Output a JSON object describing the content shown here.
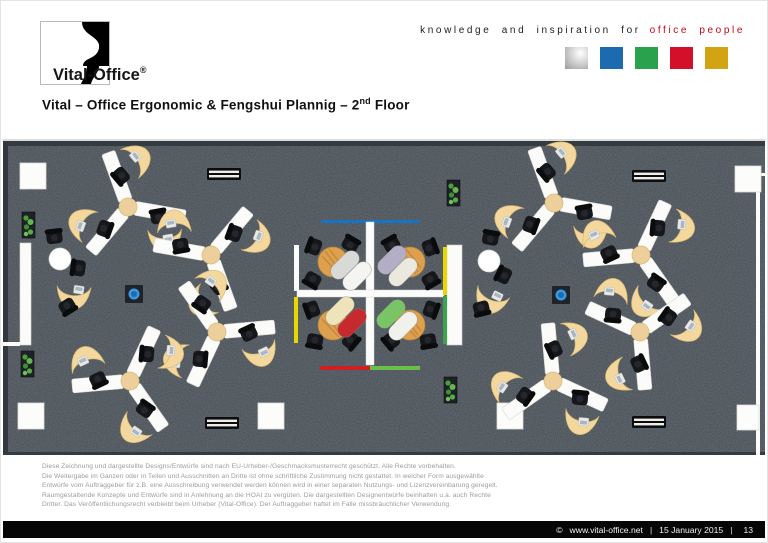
{
  "header": {
    "logo": {
      "brand": "Vital-Office",
      "registered": "®"
    },
    "tagline": {
      "black": "knowledge and inspiration for",
      "red": "office people"
    },
    "swatches": [
      {
        "name": "silver",
        "color": "#b7b7b7"
      },
      {
        "name": "blue",
        "color": "#1c6bb0"
      },
      {
        "name": "green",
        "color": "#2aa14c"
      },
      {
        "name": "red",
        "color": "#d40f2a"
      },
      {
        "name": "gold",
        "color": "#d2a413"
      }
    ]
  },
  "title": {
    "prefix": "Vital – Office Ergonomic & Fengshui Plannig  – 2",
    "superscript": "nd",
    "suffix": " Floor"
  },
  "floor_plan": {
    "description": "Top-down rendering of 2nd floor office layout",
    "carpet_color": "#434b52",
    "workstation_pinwheel_clusters": 8,
    "desks_per_cluster": 3,
    "single_workstations": 2,
    "meeting_tables": 4,
    "loungers": 8,
    "plants": 4,
    "benches": 4,
    "pillars": 6,
    "water_features": 2,
    "desk_top_color": "#f3d79c",
    "desk_frame_color": "#ffffff",
    "accent_blue": "#1a72c4",
    "accent_yellow": "#e8d800",
    "accent_green": "#3aa54a",
    "accent_red": "#cf1f26"
  },
  "legal": {
    "lines": [
      "Diese Zeichnung und dargestellte Designs/Entwürfe sind nach EU-Urheber-/Geschmacksmusterrecht geschützt. Alle Rechte vorbehalten.",
      "Die Weitergabe im Ganzen oder in Teilen und Ausschnitten an Dritte ist ohne schriftliche Zustimmung nicht gestattet. In welcher Form ausgewählte",
      "Entwürfe vom Auftraggeber für z.B. eine Ausschreibung verwendet werden können wird in einer separaten Nutzungs- und Lizenzvereinbarung geregelt.",
      "Raumgestaltende Konzepte und Entwürfe sind in Anlehnung an die HOAI zu vergüten. Die dargestellten Designentwürfe beinhalten u.a. auch Rechte",
      "Dritter. Das Veröffentlichungsrecht verbleibt beim Urheber (Vital-Office). Der Auftraggeber haftet im Falle missbräuchlicher Verwendung."
    ]
  },
  "footer": {
    "copyright": "©",
    "url": "www.vital-office.net",
    "separator": "|",
    "date": "15 January 2015",
    "page": "13"
  }
}
